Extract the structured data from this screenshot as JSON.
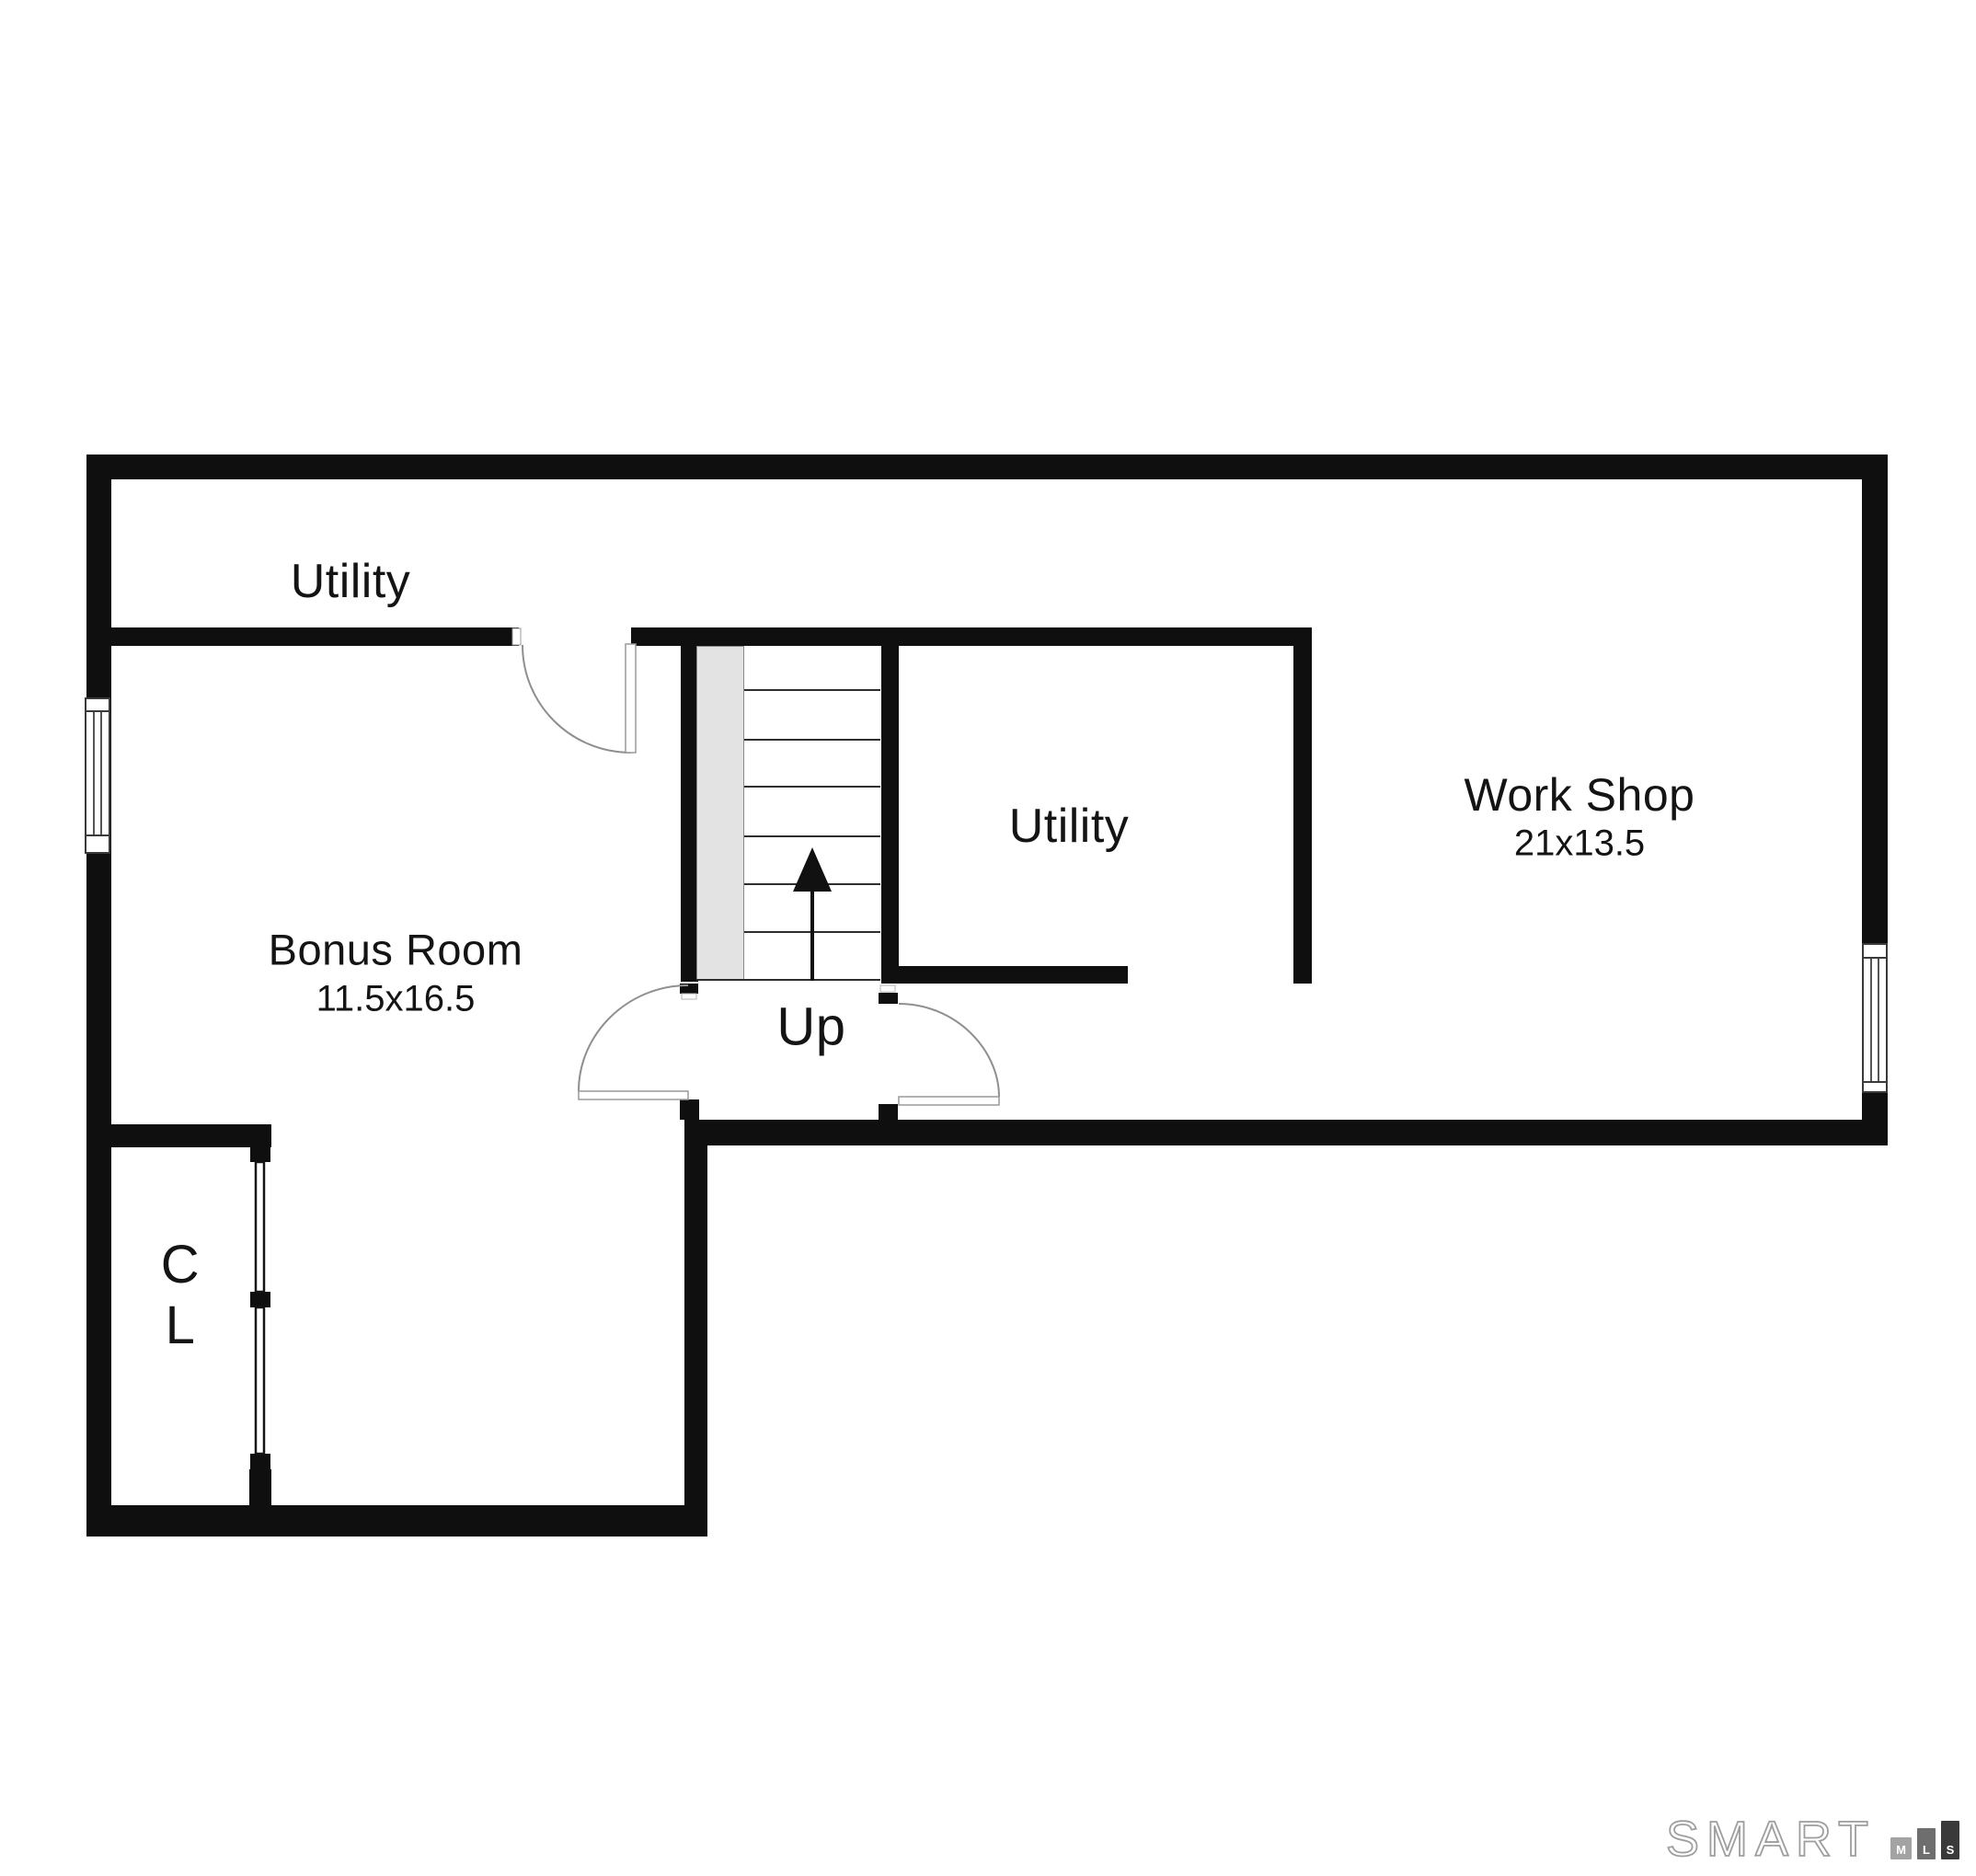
{
  "page": {
    "background_color": "#ffffff"
  },
  "floorplan": {
    "type": "floor-plan",
    "wall_color": "#0f0f0f",
    "stair_landing_color": "#e3e3e3",
    "rooms": [
      {
        "id": "utility-top",
        "label": "Utility"
      },
      {
        "id": "bonus-room",
        "label": "Bonus Room",
        "dimensions": "11.5x16.5"
      },
      {
        "id": "utility-middle",
        "label": "Utility"
      },
      {
        "id": "work-shop",
        "label": "Work Shop",
        "dimensions": "21x13.5"
      },
      {
        "id": "closet",
        "label_line1": "C",
        "label_line2": "L"
      }
    ],
    "stairs": {
      "label": "Up",
      "direction": "up",
      "tread_count": 7
    }
  },
  "branding": {
    "logo_text": "SMART",
    "outline_color": "#9e9e9e",
    "bars": [
      {
        "letter": "M",
        "color": "#a3a3a3"
      },
      {
        "letter": "L",
        "color": "#6e6e6e"
      },
      {
        "letter": "S",
        "color": "#3a3a3a"
      }
    ]
  }
}
